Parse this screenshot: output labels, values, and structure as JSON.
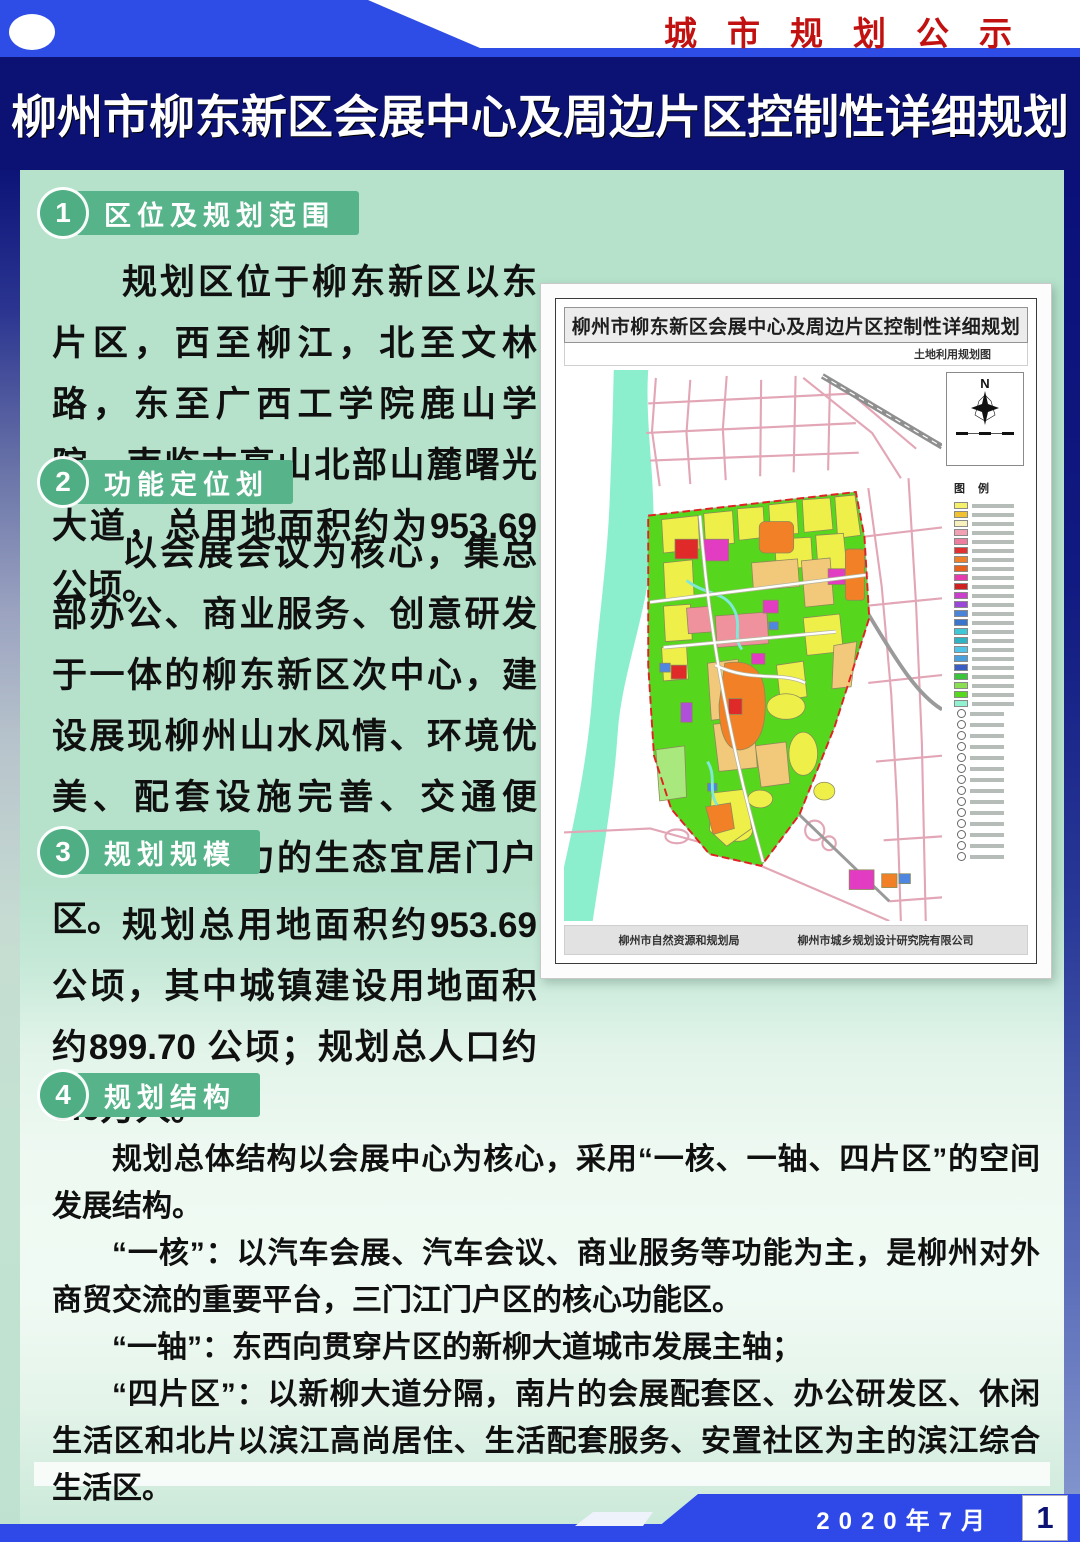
{
  "banner": {
    "notice_label": "城市规划公示"
  },
  "title": "柳州市柳东新区会展中心及周边片区控制性详细规划",
  "sections": [
    {
      "num": "1",
      "heading": "区位及规划范围",
      "paragraphs": [
        "规划区位于柳东新区以东片区，西至柳江，北至文林路，东至广西工学院鹿山学院，南临古亭山北部山麓曙光大道，总用地面积约为953.69公顷。"
      ]
    },
    {
      "num": "2",
      "heading": "功能定位划",
      "paragraphs": [
        "以会展会议为核心，集总部办公、商业服务、创意研发于一体的柳东新区次中心，建设展现柳州山水风情、环境优美、配套设施完善、交通便利、充满活力的生态宜居门户区。"
      ]
    },
    {
      "num": "3",
      "heading": "规划规模",
      "paragraphs": [
        "规划总用地面积约953.69公顷，其中城镇建设用地面积约899.70 公顷；规划总人口约8.0万人。"
      ]
    },
    {
      "num": "4",
      "heading": "规划结构",
      "paragraphs": [
        "规划总体结构以会展中心为核心，采用“一核、一轴、四片区”的空间发展结构。",
        "“一核”：以汽车会展、汽车会议、商业服务等功能为主，是柳州对外商贸交流的重要平台，三门江门户区的核心功能区。",
        "“一轴”：东西向贯穿片区的新柳大道城市发展主轴；",
        "“四片区”：以新柳大道分隔，南片的会展配套区、办公研发区、休闲生活区和北片以滨江高尚居住、生活配套服务、安置社区为主的滨江综合生活区。"
      ]
    }
  ],
  "map": {
    "title": "柳州市柳东新区会展中心及周边片区控制性详细规划",
    "subtitle": "土地利用规划图",
    "north_label": "N",
    "legend_title": "图 例",
    "legend_swatches": [
      "#f5f06a",
      "#f0c232",
      "#f7f0bc",
      "#f2a0b4",
      "#ee7ea0",
      "#e23030",
      "#f08028",
      "#e8601c",
      "#e83ab0",
      "#d02020",
      "#cc3ecc",
      "#9a46d8",
      "#4a84d8",
      "#3a74cc",
      "#3ec8d8",
      "#2eb4c4",
      "#52c4e8",
      "#4aa0dc",
      "#3a5ec4",
      "#3ac43a",
      "#8ade52",
      "#56d81e",
      "#90f2d0"
    ],
    "legend_icon_rows": 14,
    "footer_left": "柳州市自然资源和规划局",
    "footer_right": "柳州市城乡规划设计研究院有限公司"
  },
  "footer": {
    "date": "2020年7月",
    "page": "1"
  },
  "colors": {
    "accent_blue": "#2E4CE6",
    "navy_band": "#0B1274",
    "mint_panel": "#B7E2CD",
    "section_green": "#57B389",
    "banner_red": "#C21111",
    "footer_blue": "#2F49E8",
    "map_green": "#57D61E",
    "map_river": "#8BEFCD"
  }
}
